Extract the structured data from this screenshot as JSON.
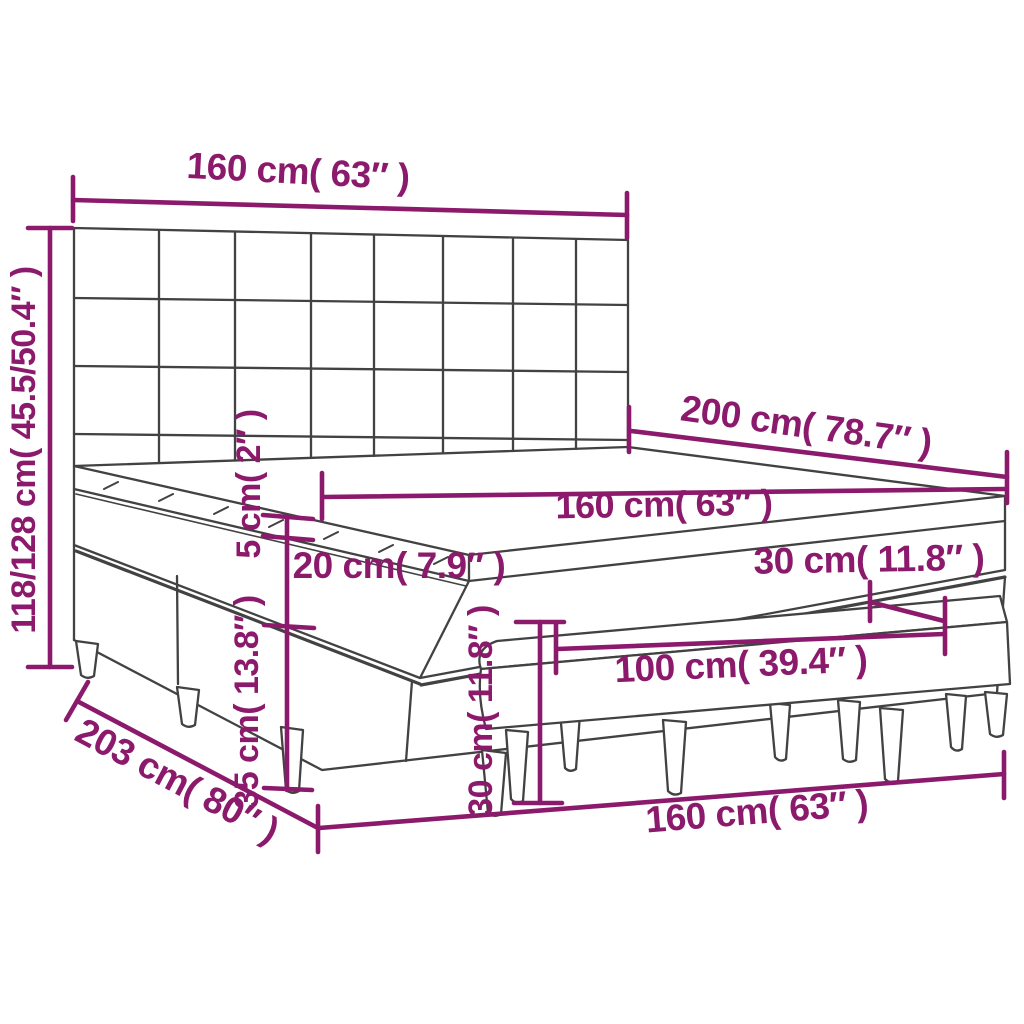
{
  "diagram": {
    "type": "product-dimension-diagram",
    "subject": "box spring bed with tufted headboard, mattress topper and bench",
    "colors": {
      "accent": "#8C1A6C",
      "outline": "#424242",
      "background": "#FFFFFF"
    },
    "dimensions": {
      "headboard_width": "160 cm( 63″ )",
      "total_height": "118/128 cm( 45.5/50.4″ )",
      "bed_length": "200 cm( 78.7″ )",
      "mattress_width": "160 cm( 63″ )",
      "topper_thickness": "5 cm( 2″ )",
      "mattress_thickness": "20 cm( 7.9″ )",
      "base_height": "35 cm( 13.8″ )",
      "frame_length": "203 cm( 80″ )",
      "frame_width": "160 cm( 63″ )",
      "bench_height": "30 cm( 11.8″ )",
      "bench_depth": "30 cm( 11.8″ )",
      "bench_length": "100 cm( 39.4″ )"
    }
  }
}
